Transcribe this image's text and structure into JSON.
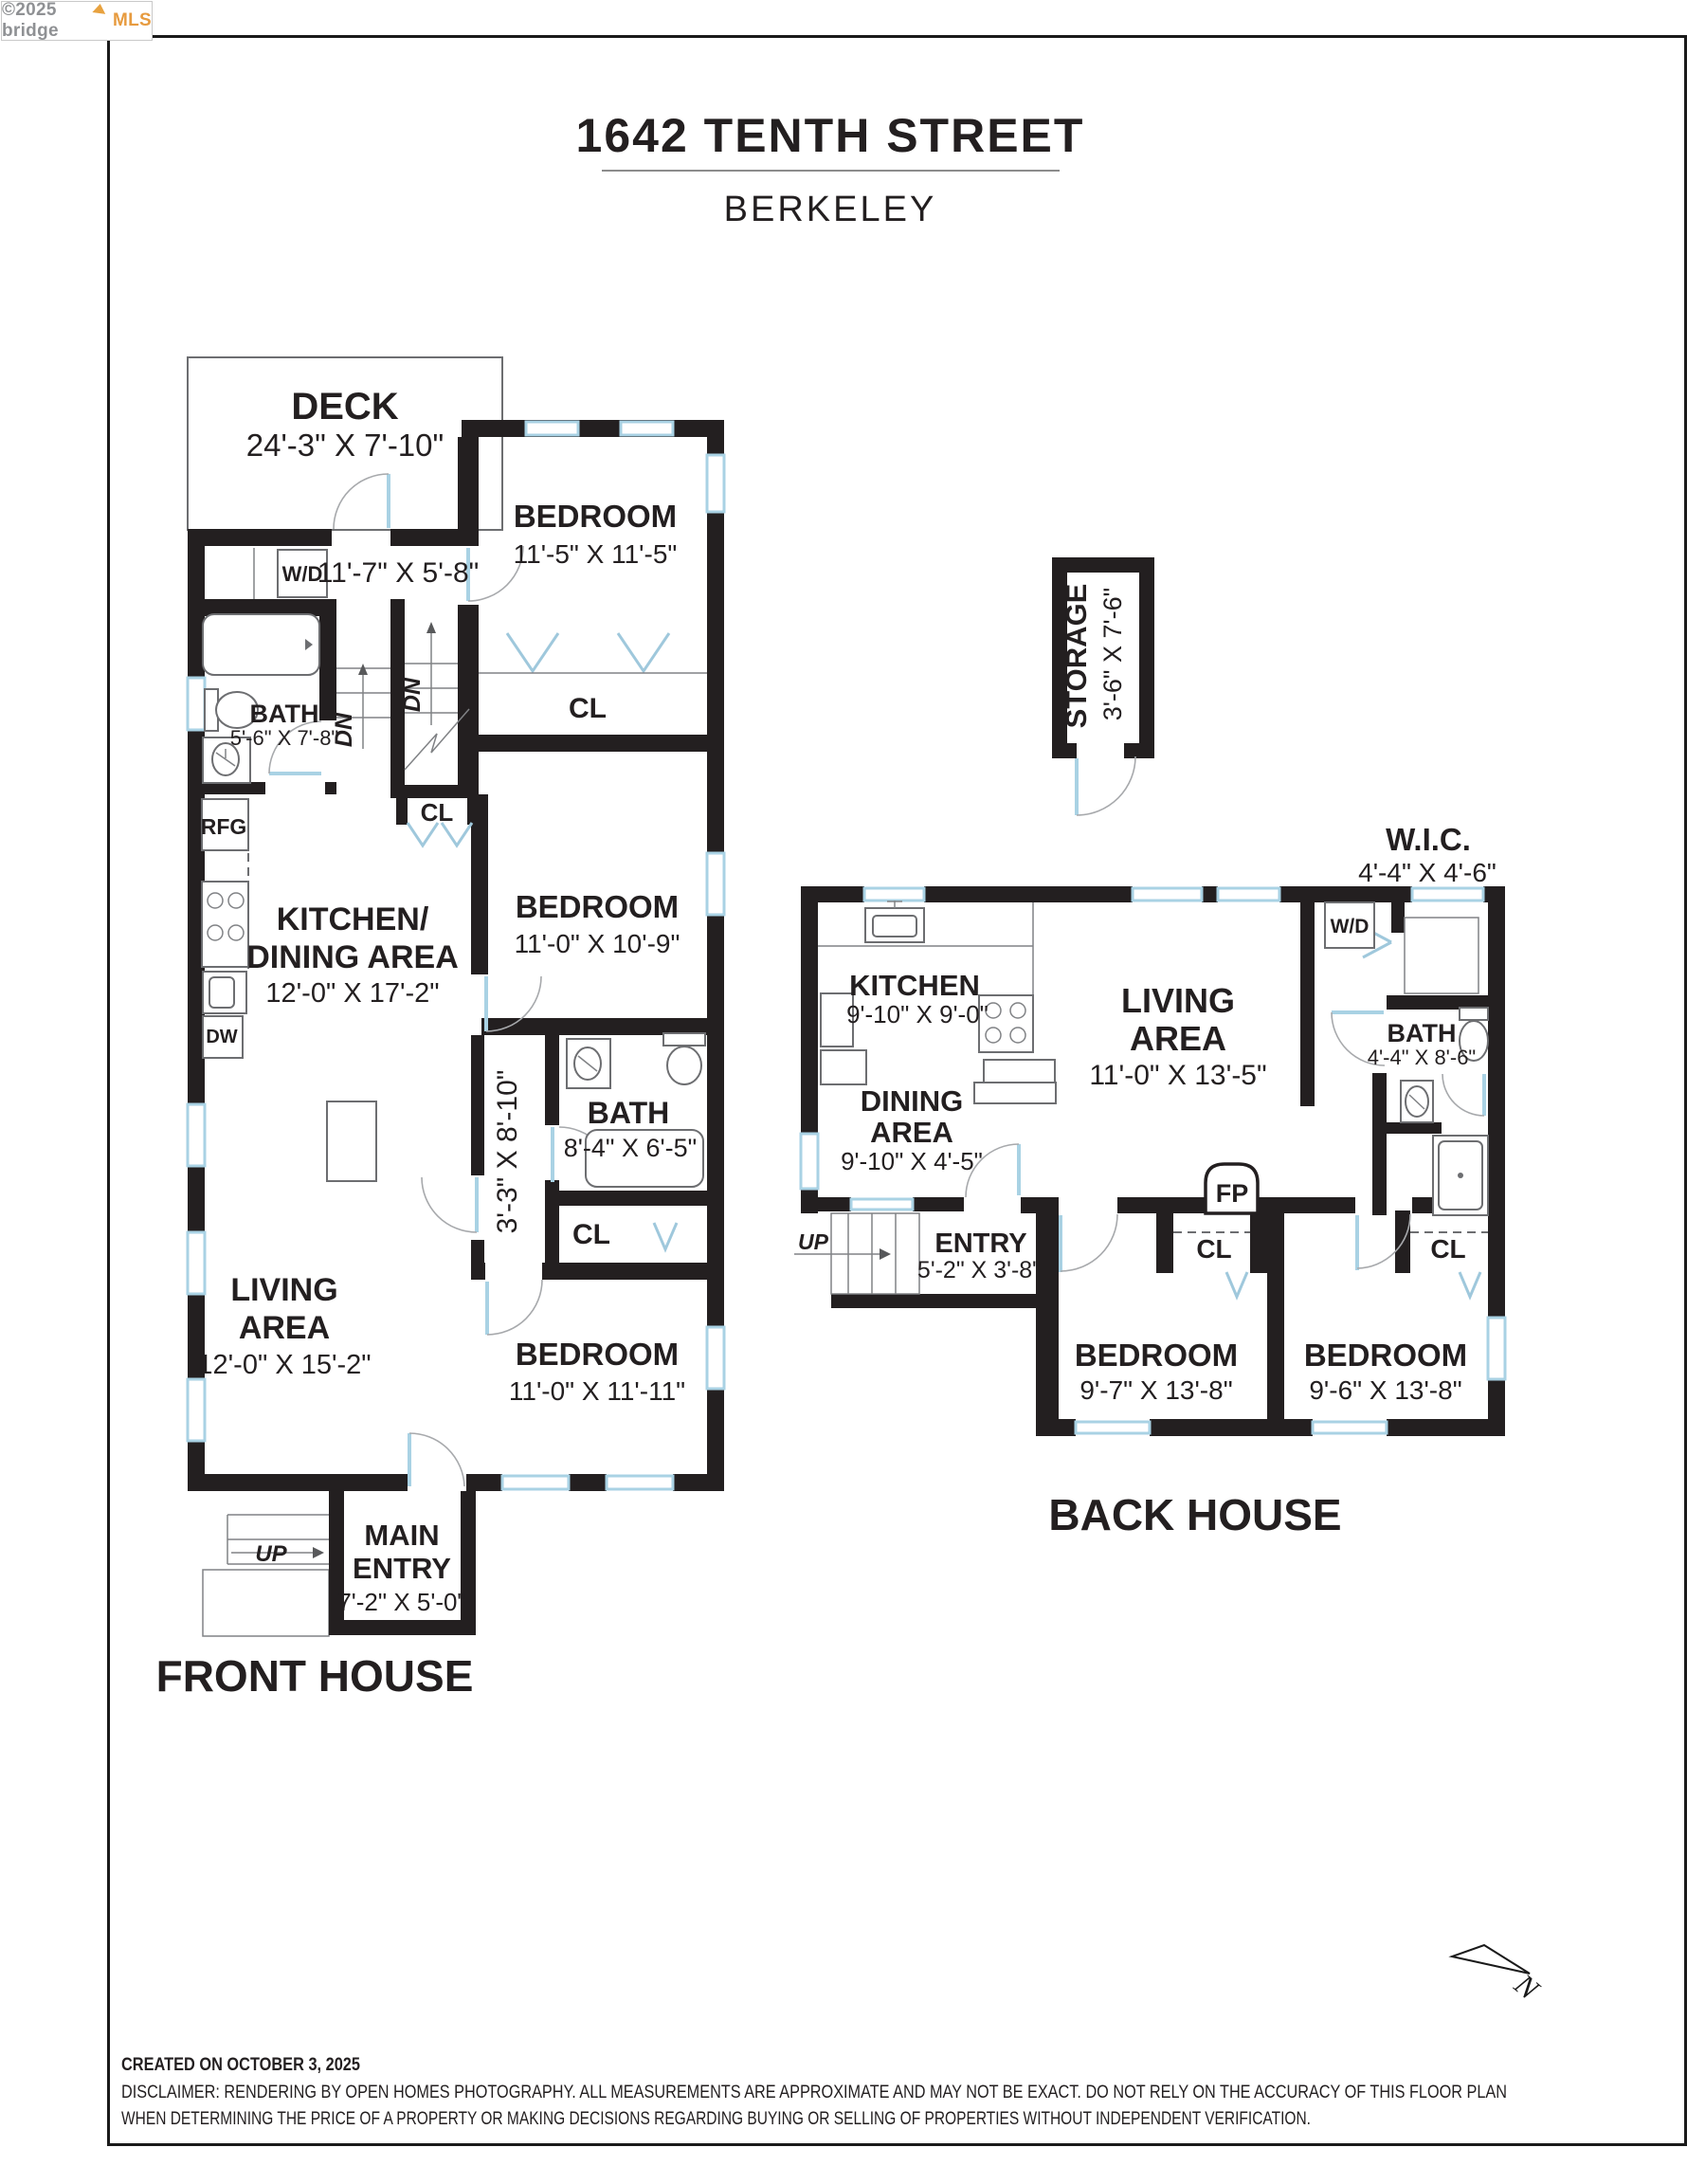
{
  "logo": {
    "copyright": "©2025 bridge",
    "brand": "MLS"
  },
  "header": {
    "title": "1642 TENTH STREET",
    "subtitle": "BERKELEY"
  },
  "labels": {
    "cl": "CL",
    "dn": "DN",
    "up": "UP",
    "wd": "W/D",
    "rfg": "RFG",
    "dw": "DW",
    "fp": "FP"
  },
  "front_house": {
    "name": "FRONT HOUSE",
    "deck": {
      "label": "DECK",
      "dims": "24'-3\" X 7'-10\""
    },
    "laundry": {
      "dims": "11'-7\" X 5'-8\""
    },
    "bath1": {
      "label": "BATH",
      "dims": "5'-6\" X 7'-8\""
    },
    "bedroom1": {
      "label": "BEDROOM",
      "dims": "11'-5\" X 11'-5\""
    },
    "bedroom2": {
      "label": "BEDROOM",
      "dims": "11'-0\" X 10'-9\""
    },
    "bedroom3": {
      "label": "BEDROOM",
      "dims": "11'-0\" X 11'-11\""
    },
    "kitchen": {
      "line1": "KITCHEN/",
      "line2": "DINING AREA",
      "dims": "12'-0\" X 17'-2\""
    },
    "living": {
      "line1": "LIVING",
      "line2": "AREA",
      "dims": "12'-0\" X 15'-2\""
    },
    "hall": {
      "dims": "3'-3\" X 8'-10\""
    },
    "bath2": {
      "label": "BATH",
      "dims": "8'-4\" X 6'-5\""
    },
    "entry": {
      "line1": "MAIN",
      "line2": "ENTRY",
      "dims": "7'-2\" X 5'-0\""
    }
  },
  "back_house": {
    "name": "BACK HOUSE",
    "storage": {
      "label": "STORAGE",
      "dims": "3'-6\" X 7'-6\""
    },
    "wic": {
      "label": "W.I.C.",
      "dims": "4'-4\" X 4'-6\""
    },
    "kitchen": {
      "label": "KITCHEN",
      "dims": "9'-10\" X 9'-0\""
    },
    "dining": {
      "line1": "DINING",
      "line2": "AREA",
      "dims": "9'-10\" X 4'-5\""
    },
    "living": {
      "line1": "LIVING",
      "line2": "AREA",
      "dims": "11'-0\" X 13'-5\""
    },
    "bath": {
      "label": "BATH",
      "dims": "4'-4\" X 8'-6\""
    },
    "entry": {
      "label": "ENTRY",
      "dims": "5'-2\" X 3'-8\""
    },
    "bedroom1": {
      "label": "BEDROOM",
      "dims": "9'-7\" X 13'-8\""
    },
    "bedroom2": {
      "label": "BEDROOM",
      "dims": "9'-6\" X 13'-8\""
    }
  },
  "compass": {
    "label": "N"
  },
  "footer": {
    "created": "CREATED ON OCTOBER 3, 2025",
    "disclaimer_line1": "DISCLAIMER: RENDERING BY OPEN HOMES PHOTOGRAPHY. ALL MEASUREMENTS ARE APPROXIMATE AND MAY NOT BE EXACT. DO NOT RELY ON THE ACCURACY OF THIS FLOOR PLAN",
    "disclaimer_line2": "WHEN DETERMINING THE PRICE OF A PROPERTY OR MAKING DECISIONS REGARDING BUYING OR SELLING OF PROPERTIES WITHOUT INDEPENDENT VERIFICATION."
  },
  "colors": {
    "wall": "#231f20",
    "window_blue": "#a9d2e4",
    "logo_orange": "#e79b3f"
  }
}
